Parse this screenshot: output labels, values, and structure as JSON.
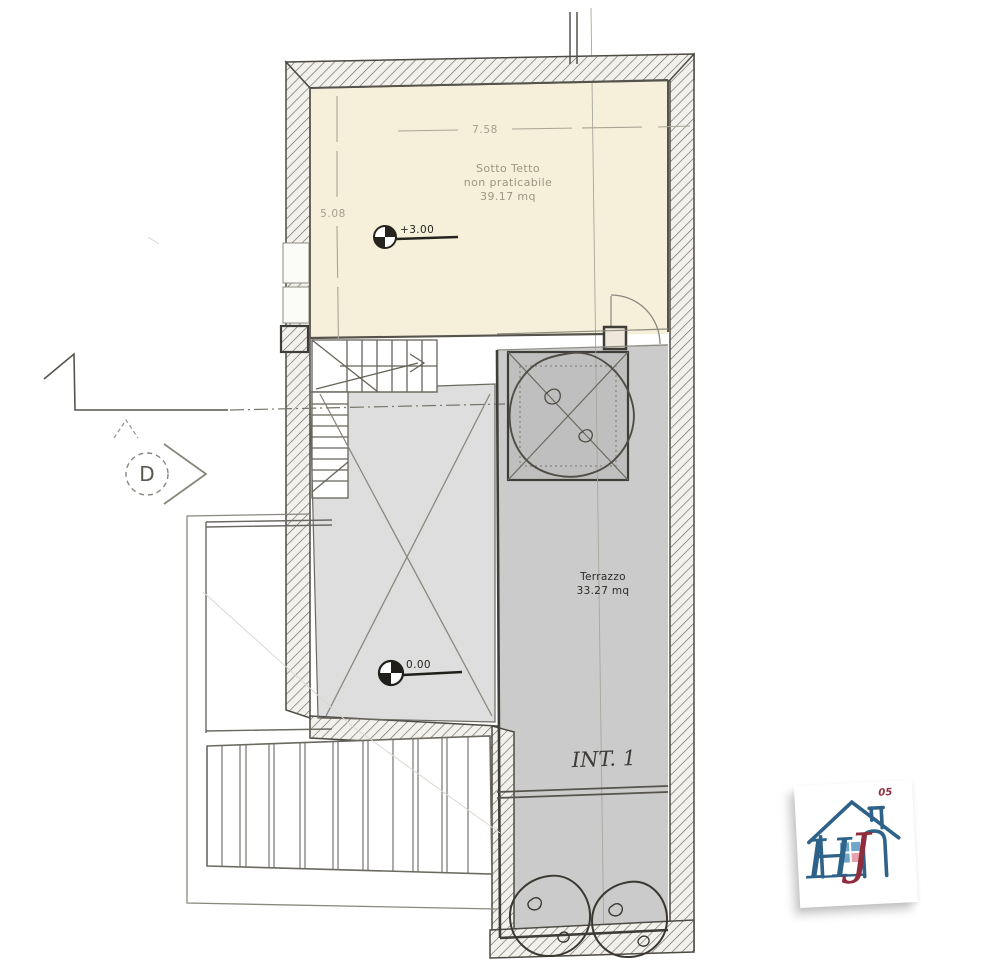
{
  "plan": {
    "dims": {
      "width": "7.58",
      "height": "5.08"
    },
    "attic": {
      "label1": "Sotto Tetto",
      "label2": "non praticabile",
      "label3": "39.17 mq",
      "level": "+3.00"
    },
    "slab": {
      "level": "0.00"
    },
    "terrace": {
      "name": "Terrazzo",
      "area": "33.27 mq",
      "unit": "INT. 1"
    },
    "section": {
      "letter": "D"
    }
  },
  "logo": {
    "letter_h": "H",
    "letter_j": "J",
    "badge": "05"
  },
  "colors": {
    "attic_fill": "#f6f0da",
    "slab_fill": "#dedede",
    "terrace_fill": "#cbcbcb",
    "planter_fill": "#bfbfbf",
    "wall_dark": "#3f3d37",
    "logo_blue": "#2e6288",
    "logo_red": "#8e2d3d"
  }
}
